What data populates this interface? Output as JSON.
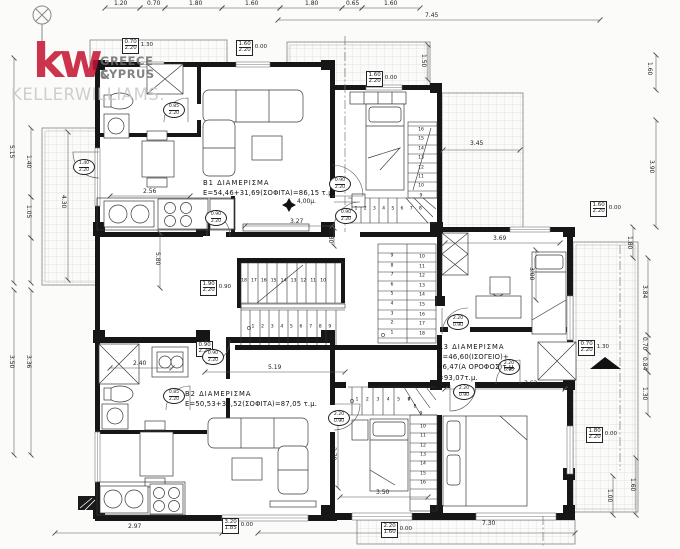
{
  "logo": {
    "mark": "kw",
    "region_line1": "GREECE &",
    "region_line2": "CYPRUS",
    "brand": "KELLERWILLIAMS.",
    "color": "#c41230"
  },
  "apartments": {
    "b1": {
      "title": "B1  ΔΙΑΜΕΡΙΣΜΑ",
      "area": "E=54,46+31,69(ΣΟΦΙΤΑ)=86,15 τ.μ."
    },
    "b2": {
      "title": "B2  ΔΙΑΜΕΡΙΣΜΑ",
      "area": "E=50,53+36,52(ΣΟΦΙΤΑ)=87,05 τ.μ."
    },
    "a3": {
      "title": "A3  ΔΙΑΜΕΡΙΣΜΑ",
      "area1": "E=46,60(ΙΣΟΓΕΙΟ)+",
      "area2": "46,47(Α ΟΡΟΦΟΣ)τ.μ.",
      "area3": "=93,07τ.μ."
    }
  },
  "labels": [
    {
      "t": "1.20",
      "x": 114,
      "y": 1
    },
    {
      "t": "0.70",
      "x": 147,
      "y": 1
    },
    {
      "t": "1.80",
      "x": 189,
      "y": 1
    },
    {
      "t": "1.60",
      "x": 245,
      "y": 1
    },
    {
      "t": "1.80",
      "x": 305,
      "y": 1
    },
    {
      "t": "0.65",
      "x": 346,
      "y": 1
    },
    {
      "t": "1.60",
      "x": 384,
      "y": 1
    },
    {
      "t": "7.45",
      "x": 425,
      "y": 13
    },
    {
      "t": "5.15",
      "x": 8,
      "y": 145,
      "r": 1
    },
    {
      "t": "1.40",
      "x": 25,
      "y": 155,
      "r": 1
    },
    {
      "t": "1.05",
      "x": 25,
      "y": 205,
      "r": 1
    },
    {
      "t": "4.30",
      "x": 60,
      "y": 195,
      "r": 1
    },
    {
      "t": "3.50",
      "x": 8,
      "y": 355,
      "r": 1
    },
    {
      "t": "3.36",
      "x": 25,
      "y": 355,
      "r": 1
    },
    {
      "t": "1.60",
      "x": 646,
      "y": 62,
      "r": 1
    },
    {
      "t": "3.90",
      "x": 648,
      "y": 160,
      "r": 1
    },
    {
      "t": "1.80",
      "x": 626,
      "y": 236,
      "r": 1
    },
    {
      "t": "3.84",
      "x": 641,
      "y": 285,
      "r": 1
    },
    {
      "t": "0.70",
      "x": 641,
      "y": 337,
      "r": 1
    },
    {
      "t": "0.84",
      "x": 641,
      "y": 357,
      "r": 1
    },
    {
      "t": "1.30",
      "x": 641,
      "y": 387,
      "r": 1
    },
    {
      "t": "1.60",
      "x": 629,
      "y": 478,
      "r": 1
    },
    {
      "t": "1.00",
      "x": 606,
      "y": 489,
      "r": 1
    },
    {
      "t": "2.97",
      "x": 128,
      "y": 524
    },
    {
      "t": "7.30",
      "x": 482,
      "y": 521
    },
    {
      "t": "2.56",
      "x": 143,
      "y": 189
    },
    {
      "t": "5.80",
      "x": 154,
      "y": 252,
      "r": 1
    },
    {
      "t": "3.27",
      "x": 290,
      "y": 219
    },
    {
      "t": "4,00μ.",
      "x": 297,
      "y": 199
    },
    {
      "t": "0.80",
      "x": 327,
      "y": 230,
      "r": 1
    },
    {
      "t": "1.50",
      "x": 420,
      "y": 54,
      "r": 1
    },
    {
      "t": "3.45",
      "x": 470,
      "y": 141
    },
    {
      "t": "3.69",
      "x": 493,
      "y": 236
    },
    {
      "t": "3.00",
      "x": 528,
      "y": 267,
      "r": 1
    },
    {
      "t": "3.62",
      "x": 524,
      "y": 381
    },
    {
      "t": "2.40",
      "x": 133,
      "y": 361
    },
    {
      "t": "5.19",
      "x": 268,
      "y": 365
    },
    {
      "t": "2.78",
      "x": 330,
      "y": 447,
      "r": 1
    },
    {
      "t": "3.50",
      "x": 376,
      "y": 490
    }
  ],
  "dim_boxes": [
    {
      "top": "0.70",
      "bot": "2.20",
      "side": "1.30",
      "x": 122,
      "y": 38
    },
    {
      "top": "1.60",
      "bot": "2.20",
      "side": "0.00",
      "x": 236,
      "y": 40
    },
    {
      "top": "1.60",
      "bot": "2.20",
      "side": "0.00",
      "x": 366,
      "y": 71
    },
    {
      "top": "1.90",
      "bot": "2.20",
      "side": "0.90",
      "x": 200,
      "y": 280
    },
    {
      "top": "0.90",
      "bot": "2.20",
      "side": "",
      "x": 196,
      "y": 341
    },
    {
      "top": "3.20",
      "bot": "1.85",
      "side": "0.00",
      "x": 222,
      "y": 518
    },
    {
      "top": "2.20",
      "bot": "1.60",
      "side": "0.00",
      "x": 381,
      "y": 522
    },
    {
      "top": "0.70",
      "bot": "2.20",
      "side": "1.30",
      "x": 578,
      "y": 340
    },
    {
      "top": "1.80",
      "bot": "2.20",
      "side": "0.00",
      "x": 586,
      "y": 427
    },
    {
      "top": "1.60",
      "bot": "2.20",
      "side": "0.00",
      "x": 590,
      "y": 201
    }
  ],
  "door_circles": [
    {
      "top": "0.85",
      "bot": "2.20",
      "x": 174,
      "y": 110
    },
    {
      "top": "1.40",
      "bot": "2.20",
      "x": 84,
      "y": 167
    },
    {
      "top": "0.90",
      "bot": "2.20",
      "x": 216,
      "y": 218
    },
    {
      "top": "0.90",
      "bot": "2.20",
      "x": 346,
      "y": 216
    },
    {
      "top": "0.90",
      "bot": "2.20",
      "x": 340,
      "y": 184
    },
    {
      "top": "2.20",
      "bot": "0.90",
      "x": 458,
      "y": 322
    },
    {
      "top": "2.20",
      "bot": "0.90",
      "x": 509,
      "y": 367
    },
    {
      "top": "2.20",
      "bot": "0.90",
      "x": 464,
      "y": 392
    },
    {
      "top": "0.85",
      "bot": "2.20",
      "x": 174,
      "y": 396
    },
    {
      "top": "0.90",
      "bot": "2.20",
      "x": 213,
      "y": 357
    },
    {
      "top": "2.20",
      "bot": "0.90",
      "x": 339,
      "y": 418
    }
  ],
  "stair_runs": [
    {
      "nums": [
        "18",
        "17",
        "16",
        "15",
        "14",
        "13",
        "12",
        "11",
        "10"
      ],
      "x": 244,
      "y": 282,
      "dx": 9.9,
      "dy": 0
    },
    {
      "nums": [
        "1",
        "2",
        "3",
        "4",
        "5",
        "6",
        "7",
        "8",
        "9"
      ],
      "x": 253,
      "y": 328,
      "dx": 9.6,
      "dy": 0
    },
    {
      "nums": [
        "1",
        "2",
        "3",
        "4",
        "5",
        "6",
        "7",
        "8"
      ],
      "x": 356,
      "y": 210,
      "dx": 9.2,
      "dy": 0
    },
    {
      "nums": [
        "16",
        "15",
        "14",
        "13",
        "12",
        "11",
        "10",
        "9"
      ],
      "x": 421,
      "y": 131,
      "dx": 0,
      "dy": 9.4
    },
    {
      "nums": [
        "9",
        "8",
        "7",
        "6",
        "5",
        "4",
        "3",
        "2",
        "1"
      ],
      "x": 392,
      "y": 257,
      "dx": 0,
      "dy": 9.6
    },
    {
      "nums": [
        "10",
        "11",
        "12",
        "13",
        "14",
        "15",
        "16",
        "17",
        "18"
      ],
      "x": 422,
      "y": 258,
      "dx": 0,
      "dy": 9.6
    },
    {
      "nums": [
        "1",
        "2",
        "3",
        "4",
        "5",
        "6"
      ],
      "x": 357,
      "y": 401,
      "dx": 10.4,
      "dy": 0
    },
    {
      "nums": [
        "7",
        "8",
        "9"
      ],
      "x": 409,
      "y": 401,
      "dx": 6,
      "dy": 7
    },
    {
      "nums": [
        "10",
        "11",
        "12",
        "13",
        "14",
        "15",
        "16"
      ],
      "x": 423,
      "y": 428,
      "dx": 0,
      "dy": 9.3
    }
  ]
}
